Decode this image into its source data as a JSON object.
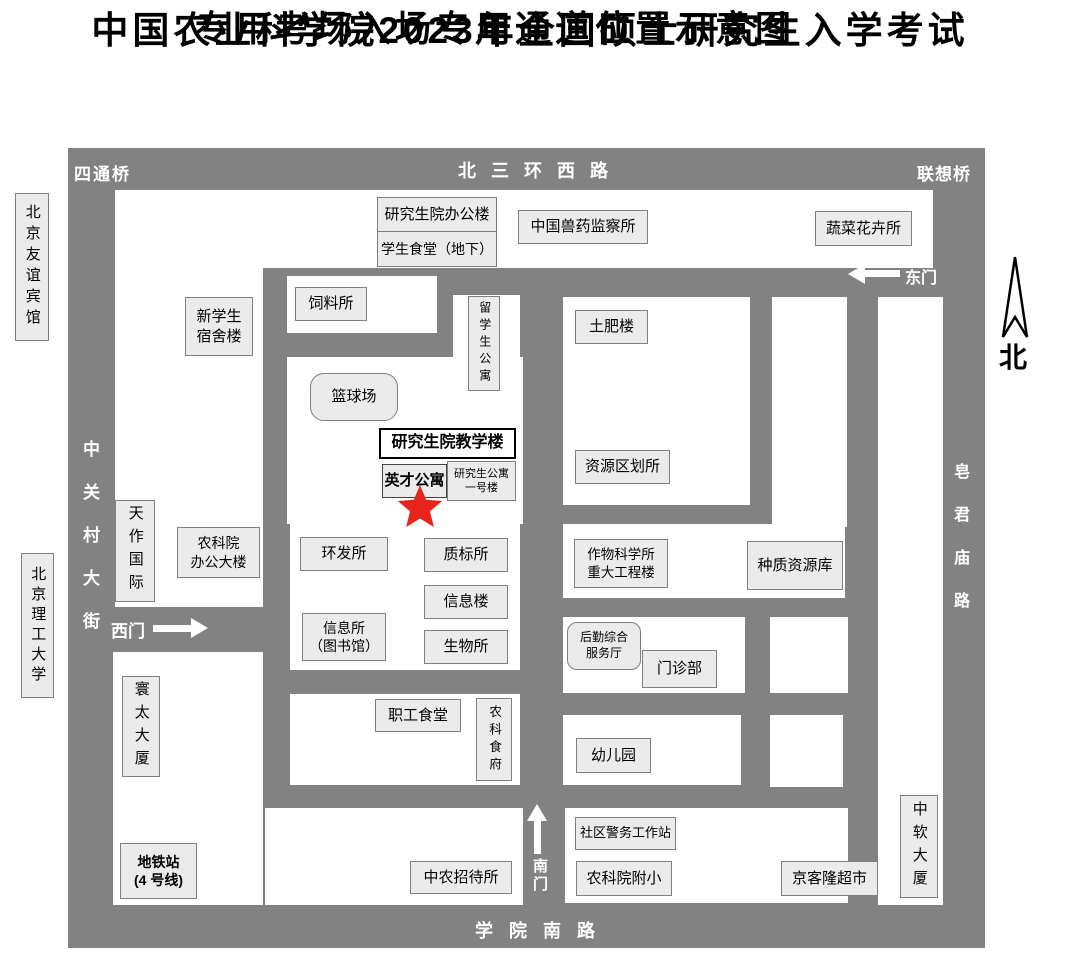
{
  "title": {
    "line1": "中国农业科学院2023年全国硕士研究生入学考试",
    "line2": "专用考场入场专用通道位置示意图"
  },
  "roads": {
    "top": "北三环西路",
    "left": "中关村大街",
    "right": "皂君庙路",
    "bottom": "学院南路"
  },
  "bridges": {
    "top_left": "四通桥",
    "top_right": "联想桥"
  },
  "gates": {
    "west": "西门",
    "east": "东门",
    "south": "南门"
  },
  "compass": {
    "north_label": "北"
  },
  "external": {
    "friendship_hotel": "北京友谊宾馆",
    "bit_university": "北京理工大学"
  },
  "buildings": {
    "grad_office": "研究生院办公楼",
    "student_canteen": "学生食堂（地下）",
    "vet_drug": "中国兽药监察所",
    "vegetable_flower": "蔬菜花卉所",
    "feed_institute": "饲料所",
    "new_student_dorm": "新学生\n宿舍楼",
    "intl_student_apt": "留学生公寓",
    "soil_fertilizer": "土肥楼",
    "basketball_court": "篮球场",
    "grad_teaching": "研究生院教学楼",
    "yingcai_apt": "英才公寓",
    "grad_apt_no1": "研究生公寓\n一号楼",
    "resource_zoning": "资源区划所",
    "tianzuo_intl": "天作国际",
    "caas_office": "农科院\n办公大楼",
    "env_dev": "环发所",
    "quality_std": "质标所",
    "crop_science": "作物科学所\n重大工程楼",
    "germplasm_bank": "种质资源库",
    "info_building": "信息楼",
    "info_institute": "信息所\n（图书馆）",
    "biology": "生物所",
    "logistics_center": "后勤综合\n服务厅",
    "clinic": "门诊部",
    "staff_canteen": "职工食堂",
    "nongke_restaurant": "农科食府",
    "kindergarten": "幼儿园",
    "huantai_tower": "寰太大厦",
    "subway_station": "地铁站\n(4 号线)",
    "zhongnong_hotel": "中农招待所",
    "community_police": "社区警务工作站",
    "caas_primary": "农科院附小",
    "jingkelong": "京客隆超市",
    "zhongruan_tower": "中软大厦"
  },
  "marker": {
    "meaning": "专用通道位置（红星标记）",
    "color": "#e8251d"
  },
  "colors": {
    "road_gray": "#828282",
    "building_fill": "#ebebeb",
    "building_border": "#7f7f7f",
    "road_text": "#ffffff",
    "star_red": "#e8251d"
  }
}
